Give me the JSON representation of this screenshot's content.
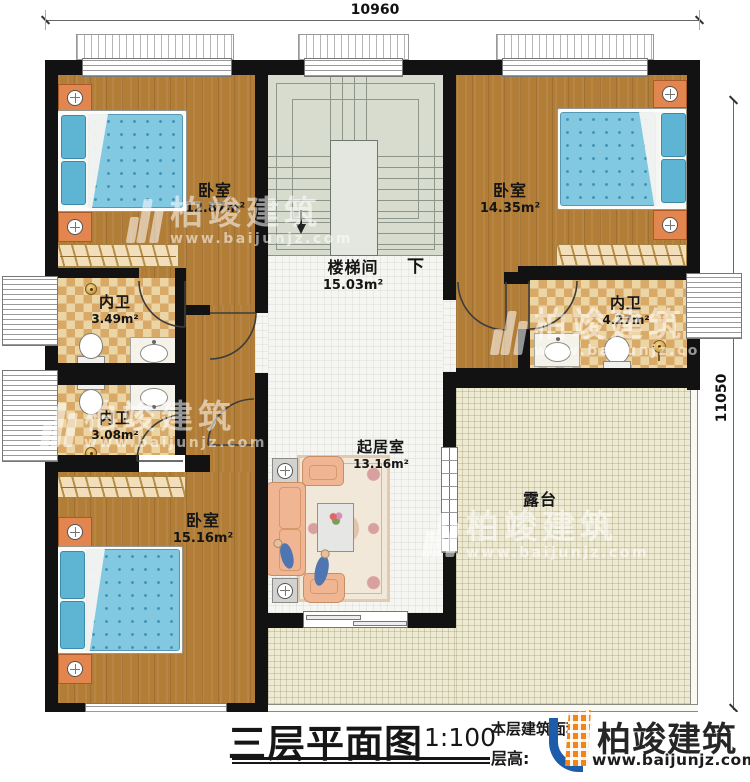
{
  "dimensions": {
    "top_width": "10960",
    "right_height": "11050"
  },
  "rooms": {
    "bedroom_top_left": {
      "name": "卧室",
      "area": "12.87m²"
    },
    "bedroom_top_right": {
      "name": "卧室",
      "area": "14.35m²"
    },
    "bedroom_bottom_left": {
      "name": "卧室",
      "area": "15.16m²"
    },
    "bathroom_left_upper": {
      "name": "内卫",
      "area": "3.49m²"
    },
    "bathroom_left_lower": {
      "name": "内卫",
      "area": "3.08m²"
    },
    "bathroom_right": {
      "name": "内卫",
      "area": "4.27m²"
    },
    "stairwell": {
      "name": "楼梯间",
      "area": "15.03m²",
      "direction_label": "下"
    },
    "living_room": {
      "name": "起居室",
      "area": "13.16m²"
    },
    "terrace": {
      "name": "露台"
    }
  },
  "footer": {
    "title": "三层平面图",
    "scale": "1:100",
    "floor_area_label": "本层建筑面积:",
    "floor_height_label": "层高:",
    "brand_name": "柏竣建筑",
    "brand_url": "www.baijunjz.com"
  },
  "watermark": {
    "brand_name": "柏竣建筑",
    "brand_url": "www.baijunjz.com"
  },
  "colors": {
    "wood": "#b27d36",
    "stair": "#d7dccf",
    "tile": "#f5f5f2",
    "terrace": "#edead4",
    "checker_light": "#ecd5a5",
    "checker_dark": "#d9a967",
    "mattress": "#83c8e1",
    "pillow": "#5db4d3",
    "nightstand": "#e2854e",
    "sofa": "#f0b693",
    "wall": "#121212",
    "brand_orange": "#f08619",
    "brand_blue": "#1c5cab"
  }
}
